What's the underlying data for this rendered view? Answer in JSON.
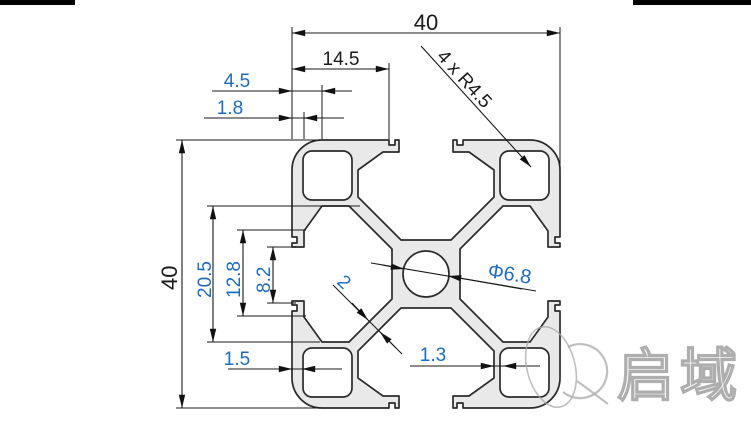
{
  "drawing": {
    "title": "4040 aluminium extrusion profile cross-section",
    "dims": {
      "overall_width": "40",
      "overall_height": "40",
      "slot_edge_offset": "14.5",
      "step_depth": "4.5",
      "lip_thickness": "1.8",
      "corner_radius_note": "4 x R4.5",
      "slot_span": "20.5",
      "slot_cavity_width": "12.8",
      "slot_opening": "8.2",
      "center_hole_dia": "Φ6.8",
      "web_thickness": "2",
      "outer_wall": "1.5",
      "inner_wall": "1.3"
    },
    "watermark": {
      "brand": "启域"
    },
    "colors": {
      "dim_text_blue": "#1e6cc0",
      "dim_text_dark": "#1a1a1a",
      "line": "#1a1a1a",
      "profile_fill": "#e9e9e9",
      "watermark_gray": "#aeaeae"
    }
  }
}
